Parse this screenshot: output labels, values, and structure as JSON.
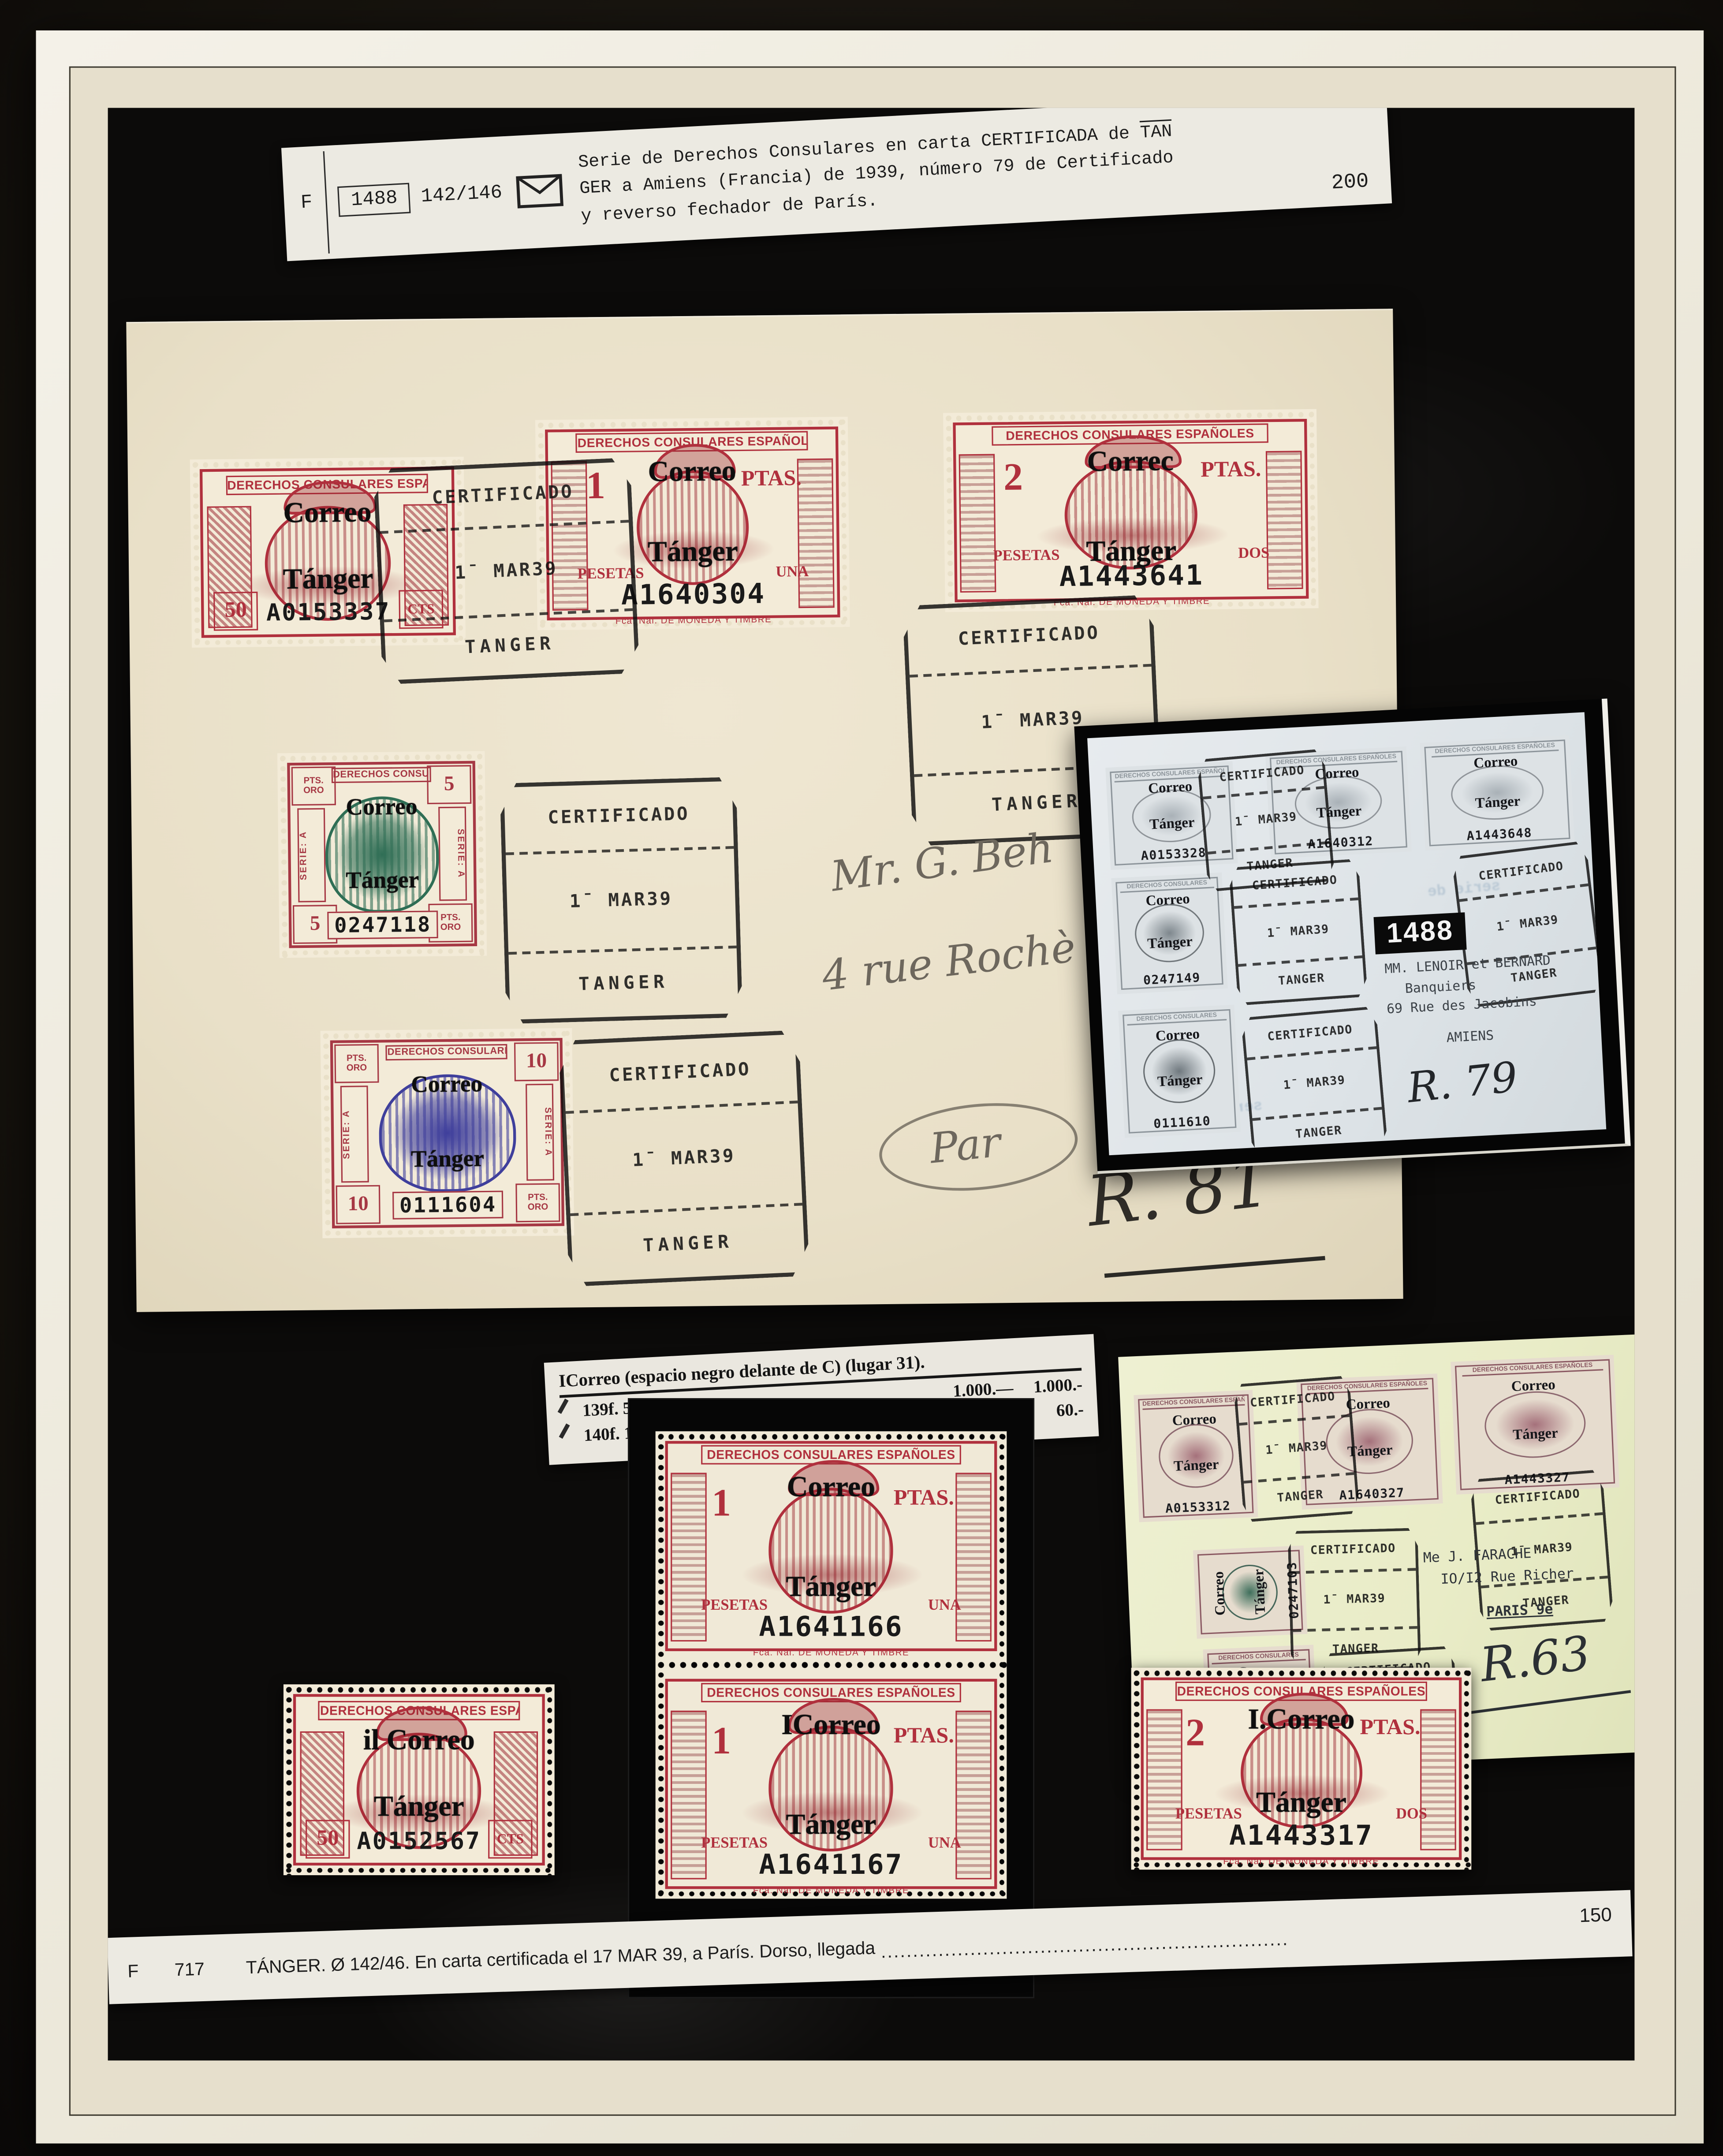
{
  "accent_colors": {
    "stamp_carmine": "#b0303d",
    "oro_frame": "#a63844",
    "green_center": "#2f6e55",
    "blue_center": "#3f3f9c",
    "album_black": "#0c0b0a",
    "envelope_cream": "#e9e0c8",
    "cover_tint": "#ebeecb"
  },
  "labels": {
    "header": "DERECHOS CONSULARES ESPAÑOLES",
    "header_short": "DERECHOS CONSULARES",
    "ptas": "PTAS.",
    "pesetas": "PESETAS",
    "una": "UNA",
    "dos": "DOS",
    "cts": "CTS",
    "pts_oro": "PTS.\nORO",
    "serie_a": "SERIE: A",
    "printer": "Fca. Nal. DE MONEDA Y TIMBRE",
    "op1": "Correo",
    "op2": "Tánger"
  },
  "postmark": {
    "l1": "CERTIFICADO",
    "l2": "1ˉ MAR39",
    "l3": "TANGER"
  },
  "top_label": {
    "f": "F",
    "number": "1488",
    "range": "142/146",
    "line1a": "Serie de Derechos Consulares en carta CERTIFICADA de ",
    "line1b": "TAN",
    "line2": "GER a Amiens (Francia) de 1939, número 79 de Certificado",
    "line3": "y reverso fechador de París.",
    "price": "200"
  },
  "envelope": {
    "stamps": {
      "s50": {
        "value": "50",
        "serial": "A0153337",
        "op1": "Correo",
        "op2": "Tánger"
      },
      "s1": {
        "value": "1",
        "serial": "A1640304",
        "word": "UNA",
        "op1": "Correo",
        "op2": "Tánger"
      },
      "s2": {
        "value": "2",
        "serial": "A1443641",
        "word": "DOS",
        "op1": "Correc",
        "op2": "Tánger"
      },
      "s5": {
        "value": "5",
        "serial": "0247118",
        "op1": "Correo",
        "op2": "Tánger"
      },
      "s10": {
        "value": "10",
        "serial": "0111604",
        "op1": "Correo",
        "op2": "Tánger"
      }
    },
    "address1": "Mr. G. Beh",
    "address2": "4 rue Rochè",
    "address3": "Par",
    "registration": "R. 81"
  },
  "inset_photo": {
    "number": "1488",
    "s50": "A0153328",
    "s1": "A1640312",
    "s2": "A1443648",
    "s5": "0247149",
    "s10": "0111610",
    "addr1": "MM. LENOIR et BERNARD",
    "addr2": "Banquiers",
    "addr3": "69 Rue des Jacobins",
    "addr4": "AMIENS",
    "registration": "R. 79",
    "show1": "de Vistas y",
    "show2": "serie de",
    "show3": "mal. P",
    "show4": "serie de 11"
  },
  "catalog": {
    "title": "ICorreo (espacio negro delante de C) (lugar 31).",
    "r1num": "139f.",
    "r1desc": "50 c. rosa",
    "r1dots": "..............................",
    "r1p1": "1.000.—",
    "r1p2": "1.000.-",
    "r2num": "140f.",
    "r2desc": "1 P. rosa",
    "r2dots": "..........................",
    "r2p1": "50.—",
    "r2p2": "60.-"
  },
  "bottom_stamps": {
    "b50": {
      "value": "50",
      "serial": "A0152567",
      "op1": "il Correo",
      "op2": "Tánger"
    },
    "p1": {
      "value": "1",
      "serial": "A1641166",
      "word": "UNA",
      "op1": "Correo",
      "op2": "Tánger"
    },
    "p2": {
      "value": "1",
      "serial": "A1641167",
      "word": "UNA",
      "op1": "ICorreo",
      "op2": "Tánger"
    },
    "b2": {
      "value": "2",
      "serial": "A1443317",
      "word": "DOS",
      "op1": "I.Correo",
      "op2": "Tánger"
    }
  },
  "cover_photo": {
    "number": "717",
    "s50": "A0153312",
    "s1": "A1640327",
    "s2": "A1443327",
    "s5": "0247103",
    "s10": "0111634",
    "addr1": "Me J. FARACHE",
    "addr2": "IO/I2 Rue Richer",
    "addr3": "PARIS 9e",
    "registration": "R.63"
  },
  "bottom_label": {
    "f": "F",
    "number": "717",
    "text": "TÁNGER. Ø 142/46. En carta certificada el 17 MAR 39, a París. Dorso, llegada",
    "dots": "................................................................",
    "price": "150"
  }
}
